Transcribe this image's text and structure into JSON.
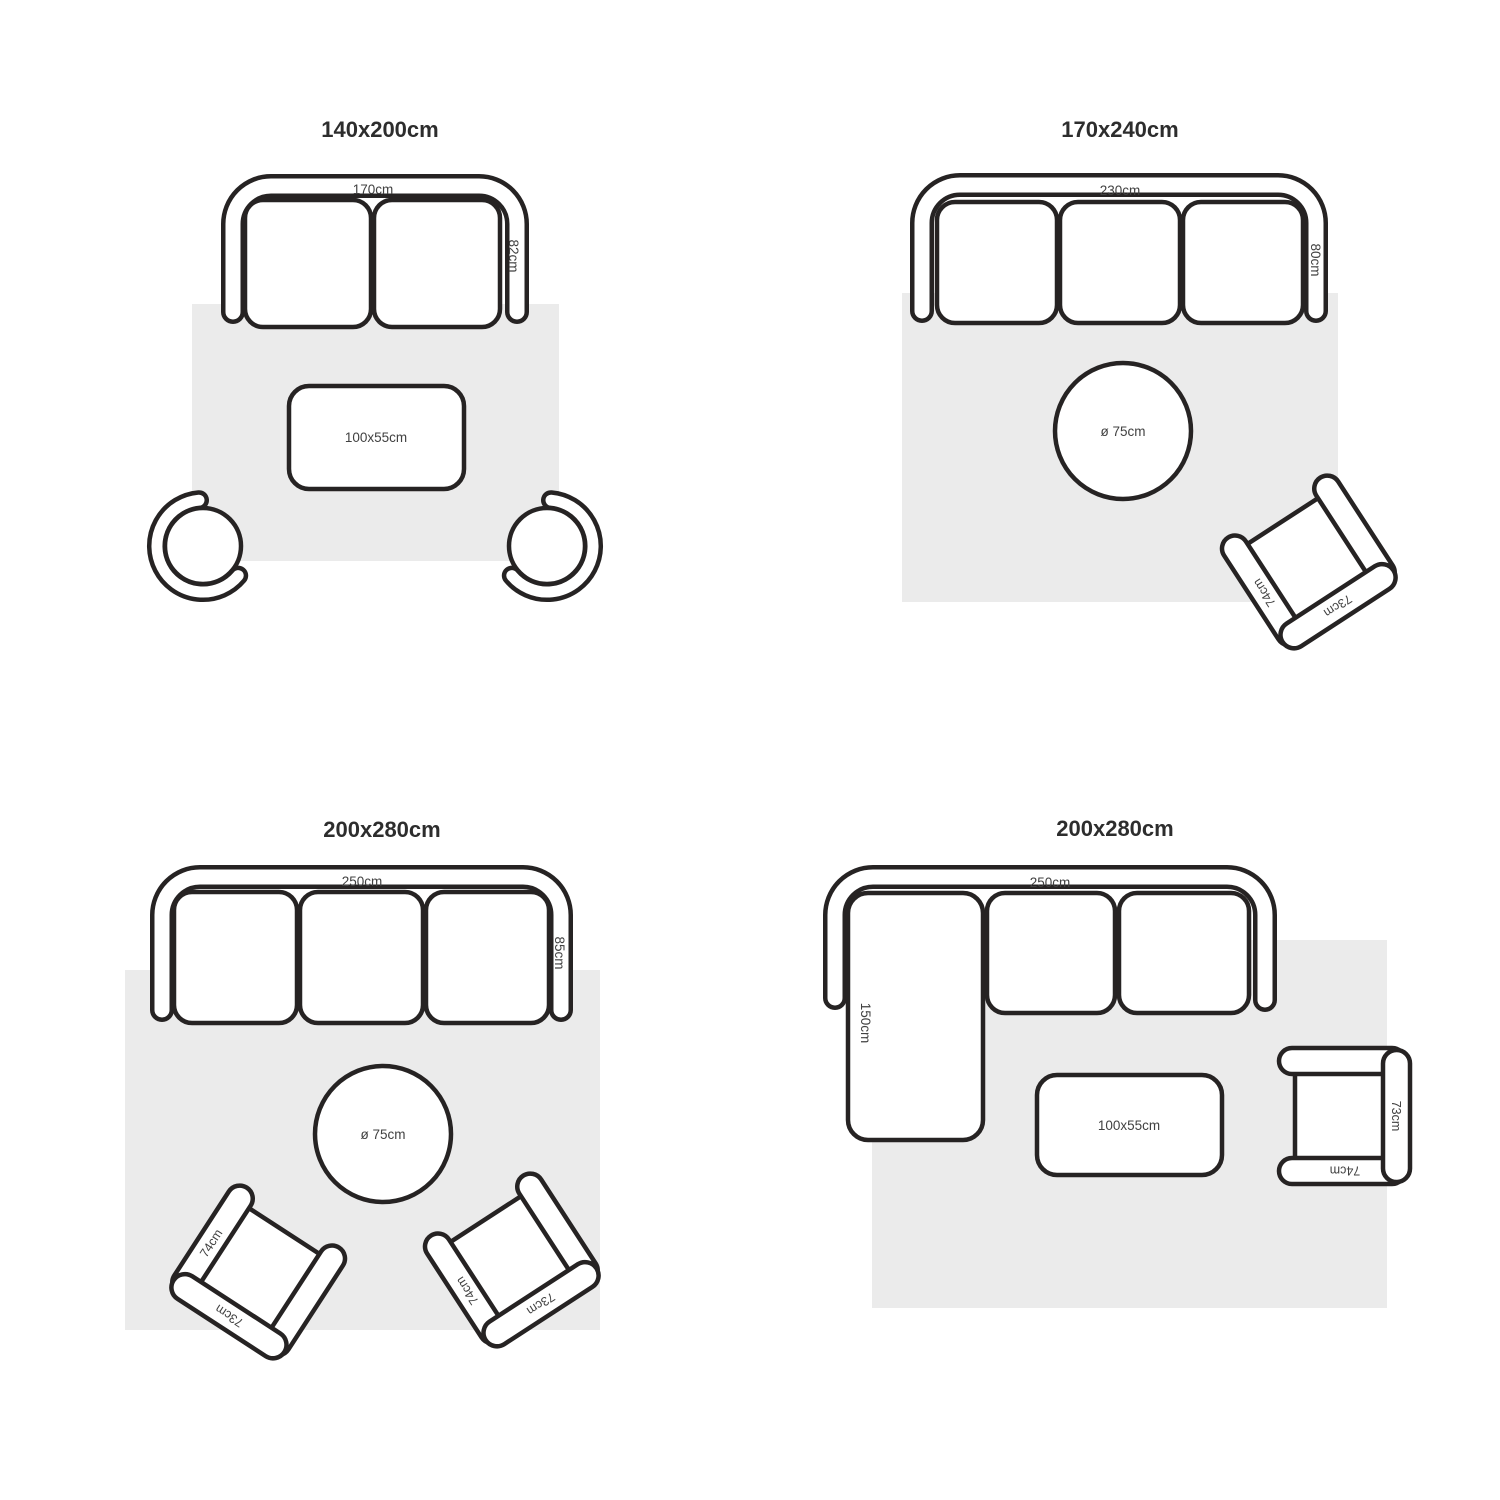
{
  "colors": {
    "outline": "#262323",
    "rug": "#ebebeb",
    "dim": "#414141",
    "title": "#2d2d2d",
    "surface": "#ffffff"
  },
  "armchair": {
    "arm_label": "74cm",
    "back_label": "73cm"
  },
  "layouts": [
    {
      "title": "140x200cm",
      "sofa_width": "170cm",
      "sofa_depth": "82cm",
      "table_label": "100x55cm"
    },
    {
      "title": "170x240cm",
      "sofa_width": "230cm",
      "sofa_depth": "80cm",
      "table_label": "ø 75cm"
    },
    {
      "title": "200x280cm",
      "sofa_width": "250cm",
      "sofa_depth": "85cm",
      "table_label": "ø 75cm"
    },
    {
      "title": "200x280cm",
      "sofa_width": "250cm",
      "chaise_depth": "150cm",
      "table_label": "100x55cm"
    }
  ]
}
